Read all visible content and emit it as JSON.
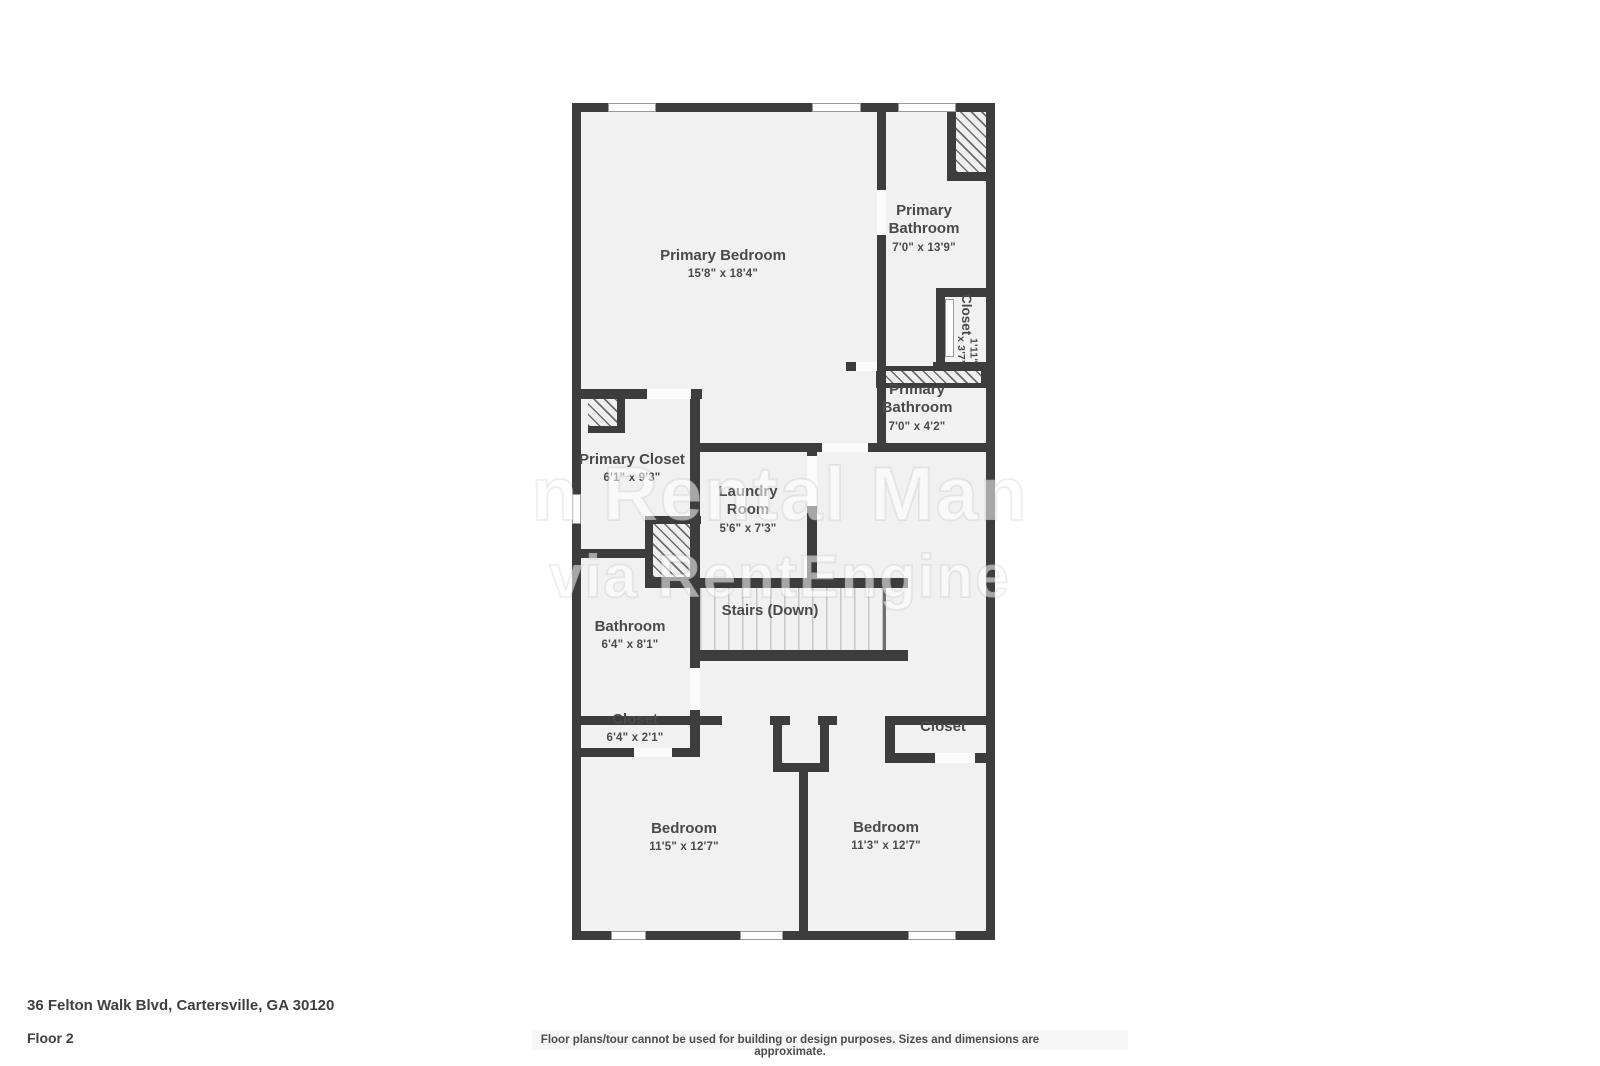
{
  "colors": {
    "wall": "#3d3d3d",
    "floor": "#f1f1f1",
    "label": "#4a4a4a",
    "background": "#ffffff"
  },
  "watermark": {
    "line1": "n Rental Man",
    "line2": "via RentEngine"
  },
  "rooms": [
    {
      "id": "primary-bedroom",
      "name": "Primary Bedroom",
      "dims": "15'8\" x 18'4\""
    },
    {
      "id": "primary-bathroom-upper",
      "name": "Primary Bathroom",
      "dims": "7'0\" x 13'9\""
    },
    {
      "id": "closet-rotated",
      "name": "Closet",
      "dims": "1'11\" x 3'7\""
    },
    {
      "id": "primary-bathroom-lower",
      "name": "Primary Bathroom",
      "dims": "7'0\" x 4'2\""
    },
    {
      "id": "primary-closet",
      "name": "Primary Closet",
      "dims": "6'1\" x 9'3\""
    },
    {
      "id": "laundry-room",
      "name": "Laundry Room",
      "dims": "5'6\" x 7'3\""
    },
    {
      "id": "stairs",
      "name": "Stairs (Down)",
      "dims": ""
    },
    {
      "id": "bathroom",
      "name": "Bathroom",
      "dims": "6'4\" x 8'1\""
    },
    {
      "id": "closet-left",
      "name": "Closet",
      "dims": "6'4\" x 2'1\""
    },
    {
      "id": "closet-right",
      "name": "Closet",
      "dims": ""
    },
    {
      "id": "bedroom-left",
      "name": "Bedroom",
      "dims": "11'5\" x 12'7\""
    },
    {
      "id": "bedroom-right",
      "name": "Bedroom",
      "dims": "11'3\" x 12'7\""
    }
  ],
  "footer": {
    "address": "36 Felton Walk Blvd, Cartersville, GA 30120",
    "floor": "Floor 2",
    "disclaimer": "Floor plans/tour cannot be used for building or design purposes. Sizes and dimensions are approximate."
  }
}
